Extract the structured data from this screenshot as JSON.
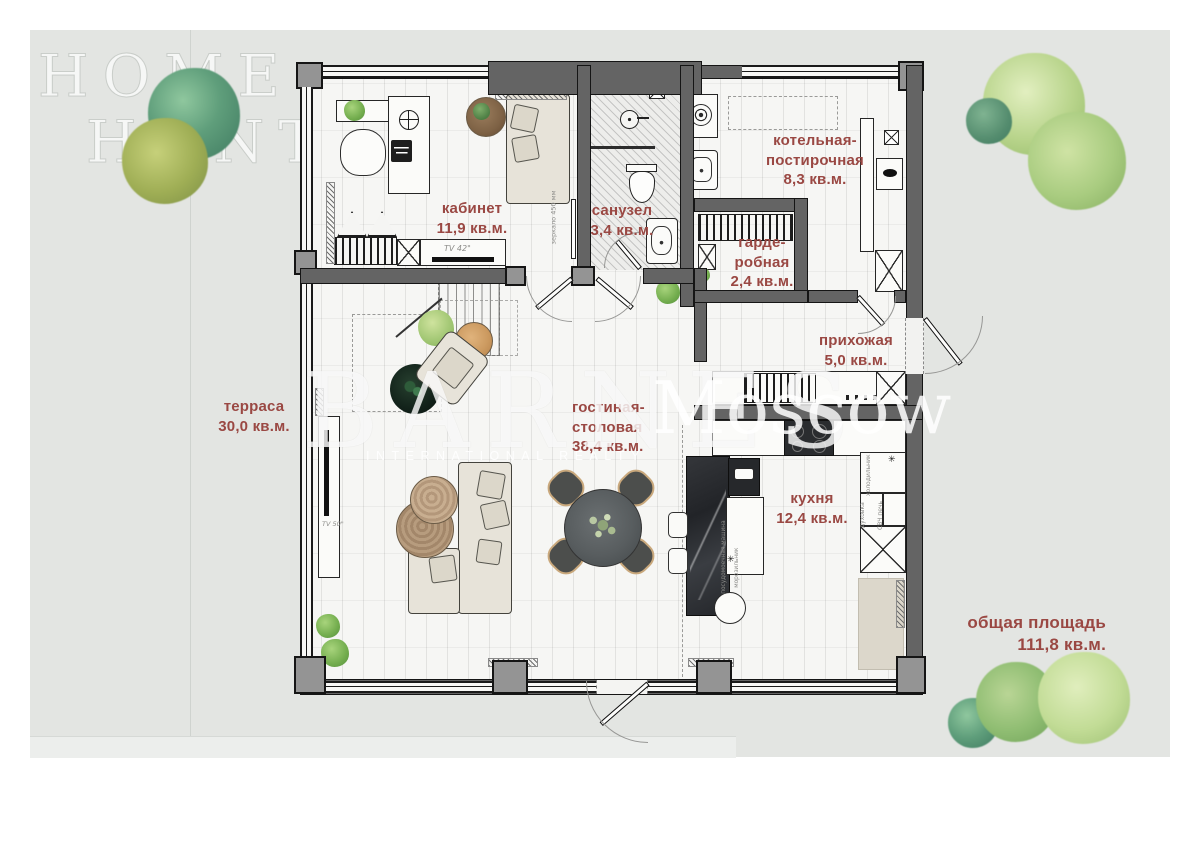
{
  "watermarks": {
    "home_hunter": {
      "line1": "HOME",
      "line2": "HUNTER"
    },
    "barnes": "BARNES",
    "barnes_tagline": "INTERNATIONAL REALTY",
    "moscow": "Moscow"
  },
  "rooms": {
    "office": {
      "label": "кабинет\n11,9 кв.м."
    },
    "bathroom": {
      "label": "санузел\n3,4 кв.м."
    },
    "boiler": {
      "label": "котельная-\nпостирочная\n8,3 кв.м."
    },
    "wardrobe": {
      "label": "гарде-\nробная\n2,4 кв.м."
    },
    "hallway": {
      "label": "прихожая\n5,0 кв.м."
    },
    "living": {
      "label": "гостиная-\nстоловая\n38,4 кв.м."
    },
    "kitchen": {
      "label": "кухня\n12,4 кв.м."
    },
    "terrace": {
      "label": "терраса\n30,0 кв.м."
    }
  },
  "total_area": {
    "label": "общая площадь\n111,8 кв.м."
  },
  "annotations": {
    "tv42": "TV 42\"",
    "tv50": "TV 50\"",
    "mirror": "зеркало 450 мм",
    "dishwasher": "посудомоечная машина",
    "freezer": "морозильник",
    "fridge": "холодильник",
    "oven": "духовка",
    "microwave": "СВЧ печь",
    "snowflake": "✳"
  },
  "colors": {
    "label_accent": "#9a4843",
    "wall": "#646464",
    "yard": "#e3e5e2",
    "floor": "#f6f6f4"
  }
}
